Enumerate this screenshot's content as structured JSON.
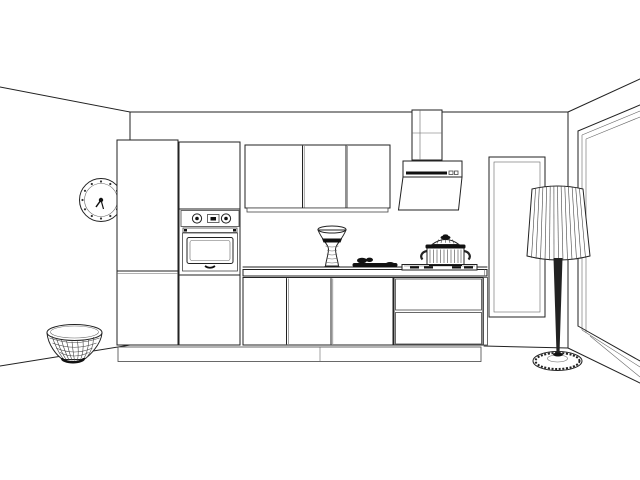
{
  "meta": {
    "title": "Kitchen interior wireframe render",
    "background_color": "#ffffff",
    "line_color": "#222222",
    "dark_fill_color": "#111111"
  },
  "scene": {
    "room": {
      "label": "Room corner view: back wall, left wall, right wall, ceiling, floor"
    },
    "objects": {
      "wall_clock": {
        "label": "Round wall clock with 12 tick marks",
        "tick_marks": 12
      },
      "tall_cabinet": {
        "label": "Tall cabinet column with split door"
      },
      "oven_column": {
        "label": "Tall oven housing column"
      },
      "oven": {
        "label": "Built-in oven with two knobs and display",
        "knobs": 2
      },
      "wall_cabinets": {
        "label": "Wall cabinets with three doors",
        "doors": 3
      },
      "range_hood": {
        "label": "Angled range hood with chimney duct"
      },
      "countertop": {
        "label": "Kitchen countertop"
      },
      "base_cabinets": {
        "label": "Base cabinets with three doors",
        "doors": 3
      },
      "drawer_unit": {
        "label": "Base unit with two drawers",
        "drawers": 2
      },
      "plinth": {
        "label": "Toe-kick plinth"
      },
      "vase": {
        "label": "Decorative hourglass vase with dark band"
      },
      "tray": {
        "label": "Board with food items on counter"
      },
      "cooktop": {
        "label": "Cooktop with dark burner grates"
      },
      "pot": {
        "label": "Ribbed cooking pot with domed lid"
      },
      "glass_panel": {
        "label": "Tall framed glass panel with reflection"
      },
      "window": {
        "label": "Large window on right wall"
      },
      "floor_lamp": {
        "label": "Floor lamp with pleated shade and round base"
      },
      "basket": {
        "label": "Woven wicker basket"
      }
    }
  }
}
